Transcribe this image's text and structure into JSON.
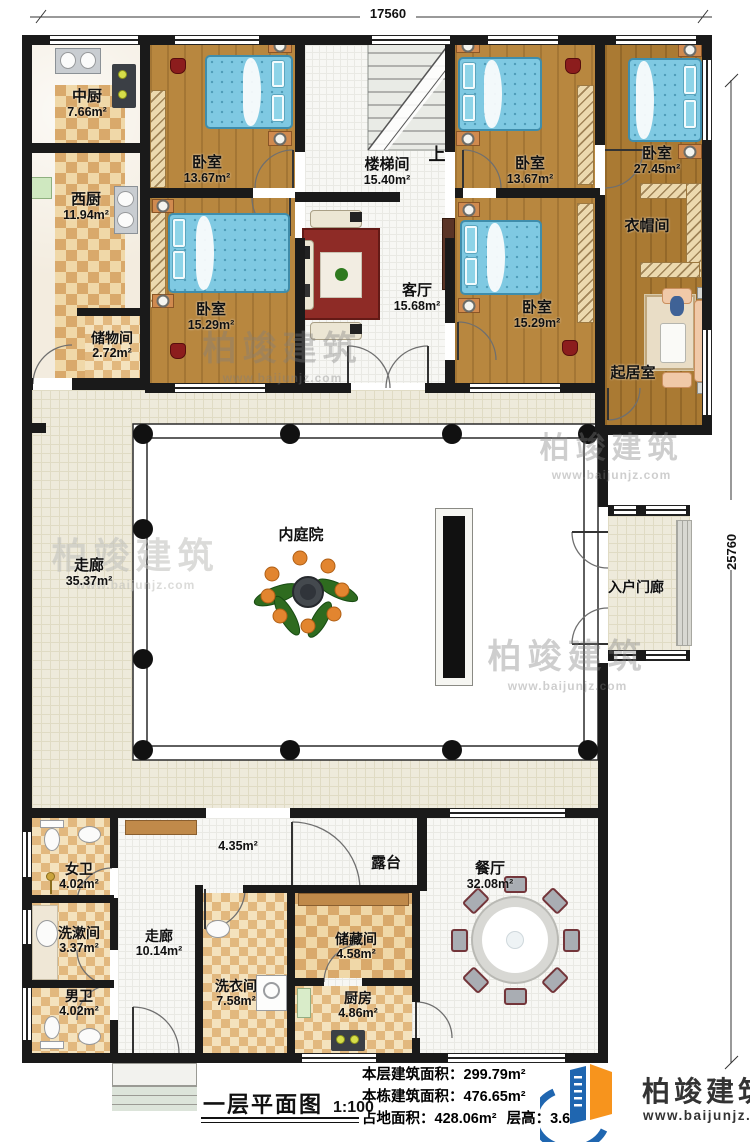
{
  "plan": {
    "dimensions": {
      "width_mm": "17560",
      "height_mm": "25760"
    },
    "stairs_up_label": "上",
    "rooms": {
      "zhongchu": {
        "name": "中厨",
        "area": "7.66m²"
      },
      "xichu": {
        "name": "西厨",
        "area": "11.94m²"
      },
      "chuwujian": {
        "name": "储物间",
        "area": "2.72m²"
      },
      "bedroom_tl": {
        "name": "卧室",
        "area": "13.67m²"
      },
      "bedroom_ml": {
        "name": "卧室",
        "area": "15.29m²"
      },
      "stairwell": {
        "name": "楼梯间",
        "area": "15.40m²"
      },
      "living": {
        "name": "客厅",
        "area": "15.68m²"
      },
      "bedroom_tr": {
        "name": "卧室",
        "area": "13.67m²"
      },
      "bedroom_mr": {
        "name": "卧室",
        "area": "15.29m²"
      },
      "bedroom_master": {
        "name": "卧室",
        "area": "27.45m²"
      },
      "cloakroom": {
        "name": "衣帽间",
        "area": ""
      },
      "sitting": {
        "name": "起居室",
        "area": ""
      },
      "corridor_main": {
        "name": "走廊",
        "area": "35.37m²"
      },
      "courtyard": {
        "name": "内庭院",
        "area": ""
      },
      "entry_porch": {
        "name": "入户门廊",
        "area": ""
      },
      "bath_women": {
        "name": "女卫",
        "area": "4.02m²"
      },
      "washroom": {
        "name": "洗漱间",
        "area": "3.37m²"
      },
      "bath_men": {
        "name": "男卫",
        "area": "4.02m²"
      },
      "corridor_small": {
        "name": "走廊",
        "area": "10.14m²"
      },
      "hall_small": {
        "name": "",
        "area": "4.35m²"
      },
      "terrace": {
        "name": "露台",
        "area": ""
      },
      "dining": {
        "name": "餐厅",
        "area": "32.08m²"
      },
      "laundry": {
        "name": "洗衣间",
        "area": "7.58m²"
      },
      "storeroom": {
        "name": "储藏间",
        "area": "4.58m²"
      },
      "kitchen": {
        "name": "厨房",
        "area": "4.86m²"
      }
    },
    "watermark": {
      "text": "柏竣建筑",
      "url": "www.baijunjz.com"
    },
    "footer": {
      "title": "一层平面图",
      "scale": "1:100",
      "stats": [
        {
          "label": "本层建筑面积：",
          "value": "299.79m²"
        },
        {
          "label": "本栋建筑面积：",
          "value": "476.65m²"
        },
        {
          "label": "占地面积：",
          "value": "428.06m²"
        },
        {
          "label": "层高：",
          "value": "3.6"
        }
      ]
    },
    "logo": {
      "name": "柏竣建筑",
      "url": "www.baijunjz.com"
    },
    "colors": {
      "wall": "#1a1a1a",
      "wood": "#b8873f",
      "checker_tan": "#d9a96b",
      "walkway_tile": "#eeeadb",
      "white_tile": "#f7f7f4",
      "bed_blue": "#7fc9e2",
      "rug_red": "#8e2b26",
      "logo_blue": "#1f66b0",
      "logo_orange": "#f7941d"
    }
  }
}
